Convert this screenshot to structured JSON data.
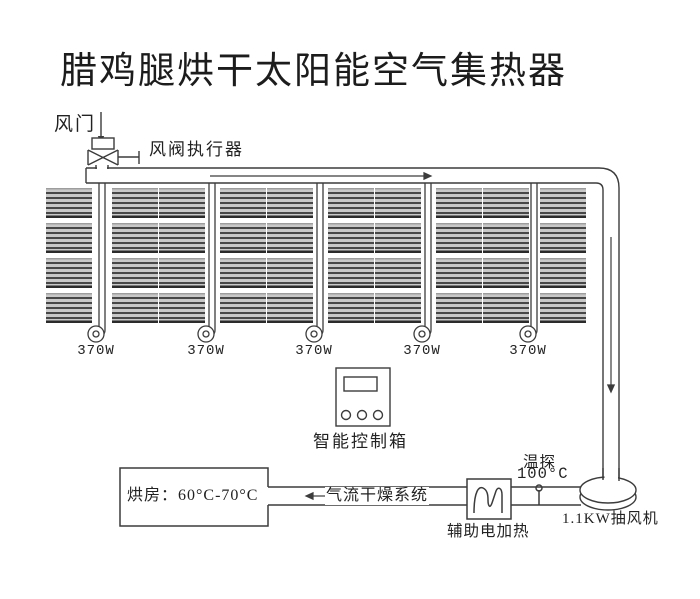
{
  "title": "腊鸡腿烘干太阳能空气集热器",
  "damper": {
    "label": "风门",
    "actuator_label": "风阀执行器"
  },
  "collector_array": {
    "columns": 10,
    "rows": 4,
    "fan_labels": [
      "370W",
      "370W",
      "370W",
      "370W",
      "370W"
    ]
  },
  "control_box": {
    "label": "智能控制箱",
    "button_count": 3
  },
  "drying_room": {
    "label": "烘房：60°C-70°C"
  },
  "air_duct": {
    "label": "气流干燥系统"
  },
  "aux_heater": {
    "label": "辅助电加热"
  },
  "temp_probe": {
    "label": "温探",
    "value": "100°C"
  },
  "exhaust_fan": {
    "label": "1.1KW抽风机"
  },
  "colors": {
    "line": "#3c3c3c",
    "panel_base": "#c8c8c8",
    "panel_stripe": "#474747",
    "background": "#ffffff"
  }
}
